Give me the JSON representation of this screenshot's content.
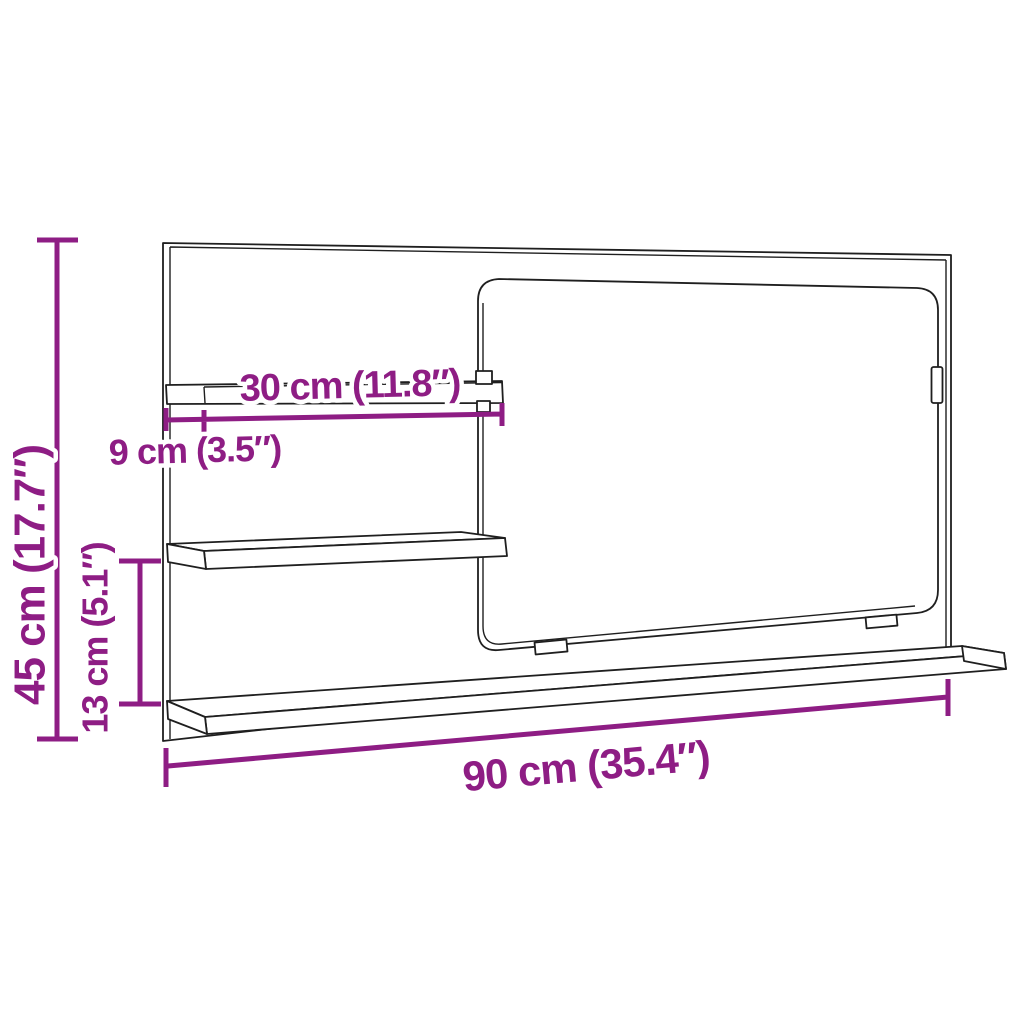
{
  "diagram": {
    "kind": "product-dimension-diagram",
    "subject": "wall bathroom mirror unit with shelves",
    "background_color": "#ffffff",
    "outline_color": "#1f1f1f",
    "accent_color": "#8e1d84",
    "labels": {
      "height": "45 cm (17.7″)",
      "width": "90 cm (35.4″)",
      "shelf_length": "30 cm (11.8″)",
      "shelf_depth": "9 cm (3.5″)",
      "shelf_gap": "13 cm (5.1″)"
    }
  }
}
